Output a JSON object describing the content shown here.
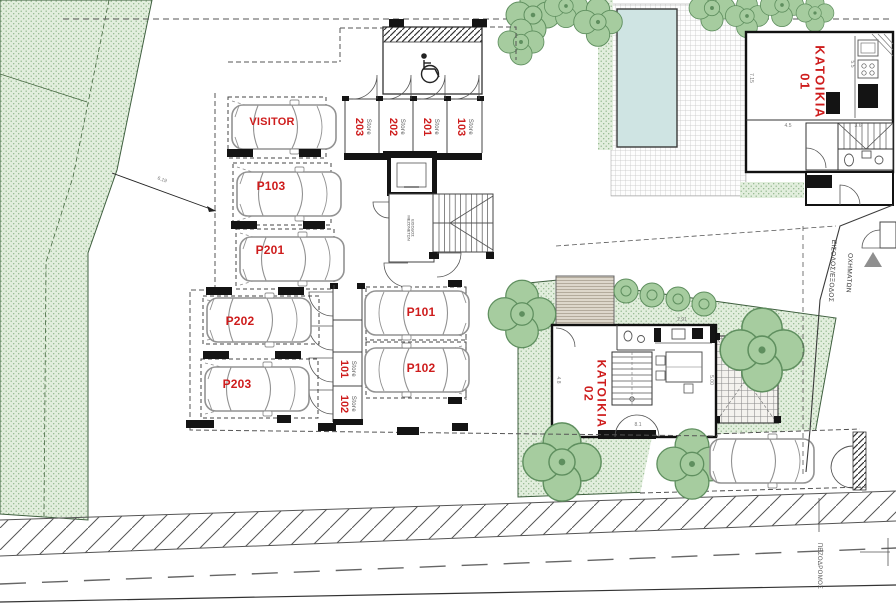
{
  "parking": {
    "stalls": [
      {
        "id": "visitor",
        "label": "VISITOR"
      },
      {
        "id": "p103",
        "label": "P103"
      },
      {
        "id": "p201",
        "label": "P201"
      },
      {
        "id": "p202",
        "label": "P202"
      },
      {
        "id": "p203",
        "label": "P203"
      },
      {
        "id": "p101",
        "label": "P101"
      },
      {
        "id": "p102",
        "label": "P102"
      }
    ]
  },
  "stores": {
    "word": "Store",
    "top": [
      "203",
      "202",
      "201",
      "103"
    ],
    "middle": [
      "101",
      "102"
    ]
  },
  "houses": {
    "h1": {
      "name": "ΚΑΤΟΙΚΙΑ",
      "number": "01"
    },
    "h2": {
      "name": "ΚΑΤΟΙΚΙΑ",
      "number": "02"
    }
  },
  "site_labels": {
    "vehicle_entrance_1": "ΕΙΣΟΔΟΣ/ΕΞΟΔΟΣ",
    "vehicle_entrance_2": "ΟΧΗΜΑΤΩΝ",
    "sidewalk": "ΠΕΖΟΔΡΟΜΟΣ",
    "core_entrance_1": "ΕΙΣΟΔΟΣ",
    "core_entrance_2": "ΜΕΖΟΝΕΤΩΝ"
  },
  "dimensions": {
    "site_leader": "6.19",
    "h1_depth": "7.15",
    "h1_room": "4.5",
    "h1_stair": "3.6",
    "h1_kitchen": "5.5",
    "h2_kitchen": "2.91",
    "h2_right": "5.00",
    "h2_bottom": "8.1",
    "h2_left": "4.8"
  },
  "colors": {
    "label_red": "#ce1c1c",
    "green_fill": "#e2eedd",
    "green_dot": "#90b68b",
    "tree_fill": "#a6cc9f",
    "tree_stroke": "#5f8f5f",
    "pool_blue": "#cfe4e3",
    "wall_black": "#141414",
    "line_gray": "#8d8d8d",
    "deck_tan": "#ddd7cb"
  }
}
